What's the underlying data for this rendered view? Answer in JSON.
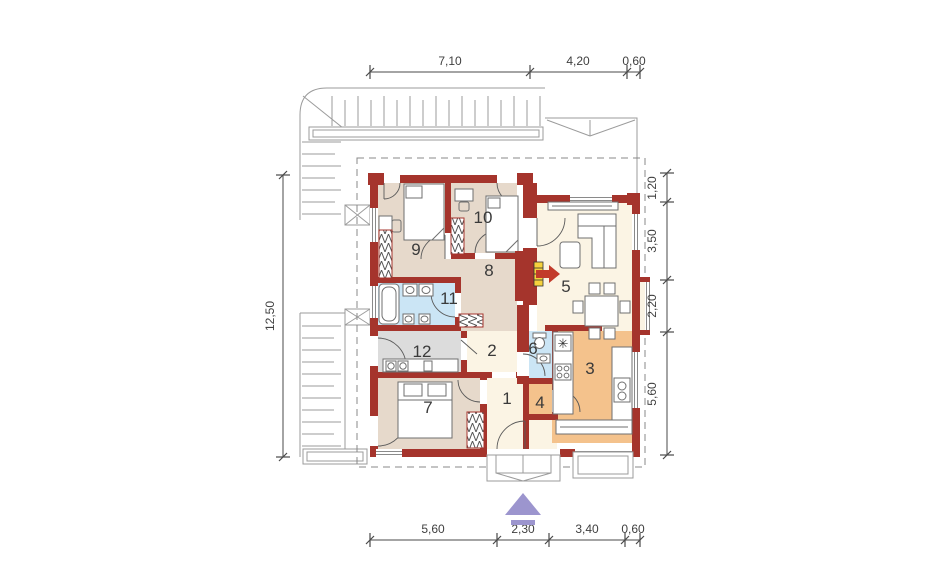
{
  "document": {
    "type": "house-floor-plan"
  },
  "rooms": [
    {
      "label": "1"
    },
    {
      "label": "2"
    },
    {
      "label": "3"
    },
    {
      "label": "4"
    },
    {
      "label": "5"
    },
    {
      "label": "6"
    },
    {
      "label": "7"
    },
    {
      "label": "8"
    },
    {
      "label": "9"
    },
    {
      "label": "10"
    },
    {
      "label": "11"
    },
    {
      "label": "12"
    }
  ],
  "dimensions": {
    "top": [
      "7,10",
      "4,20",
      "0,60"
    ],
    "bottom": [
      "5,60",
      "2,30",
      "3,40",
      "0,60"
    ],
    "left": [
      "12,50"
    ],
    "right": [
      "1,20",
      "3,50",
      "2,20",
      "5,60"
    ]
  },
  "colors": {
    "wall": "#A5342C",
    "bedroom_fill": "#E6D9CB",
    "living_fill": "#FBF4E4",
    "kitchen_fill": "#F4C28C",
    "bath_fill": "#CBE5F5",
    "utility_fill": "#DCDCDC",
    "terrace_line": "#9B9B9B",
    "entrance_arrow": "#9C95CE",
    "fireplace_accent": "#F5D23D",
    "fireplace_arrow": "#C23B2B"
  }
}
